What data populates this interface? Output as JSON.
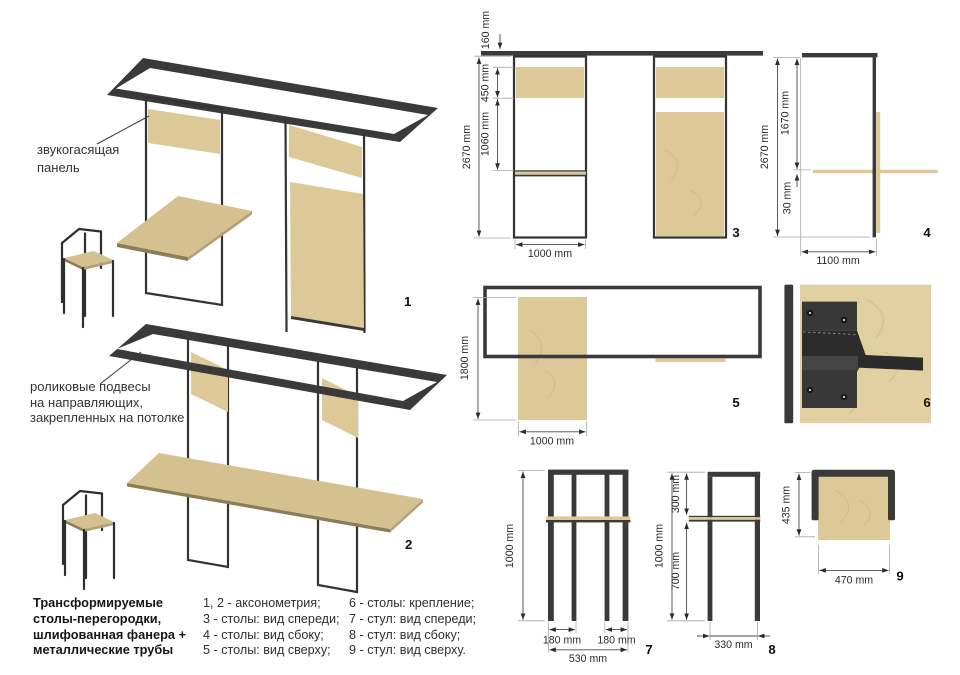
{
  "title_block": {
    "lines": [
      "Трансформируемые",
      "столы-перегородки,",
      "шлифованная фанера +",
      "металлические трубы"
    ]
  },
  "legend": {
    "col1": [
      "1, 2 - аксонометрия;",
      "3 - столы: вид спереди;",
      "4 - столы: вид сбоку;",
      "5 - столы: вид сверху;"
    ],
    "col2": [
      "6 - столы: крепление;",
      "7 - стул: вид спереди;",
      "8 - стул: вид сбоку;",
      "9 - стул: вид сверху."
    ]
  },
  "annotations": {
    "panel": [
      "звукогасящая",
      "панель"
    ],
    "rollers": [
      "роликовые подвесы",
      "на направляющих,",
      "закрепленных на потолке"
    ]
  },
  "view_labels": {
    "v1": "1",
    "v2": "2",
    "v3": "3",
    "v4": "4",
    "v5": "5",
    "v6": "6",
    "v7": "7",
    "v8": "8",
    "v9": "9"
  },
  "dims": {
    "v3": {
      "d160": "160 mm",
      "d450": "450 mm",
      "d1060": "1060 mm",
      "d2670": "2670 mm",
      "w1000": "1000 mm"
    },
    "v4": {
      "d2670": "2670 mm",
      "d1670": "1670 mm",
      "d30": "30 mm",
      "w1100": "1100 mm"
    },
    "v5": {
      "d1800": "1800 mm",
      "w1000": "1000 mm"
    },
    "v7": {
      "h1000": "1000 mm",
      "w180a": "180 mm",
      "w180b": "180 mm",
      "w530": "530 mm"
    },
    "v8": {
      "h1000": "1000 mm",
      "h300": "300 mm",
      "h700": "700 mm",
      "w330": "330 mm"
    },
    "v9": {
      "h435": "435 mm",
      "w470": "470 mm"
    }
  },
  "colors": {
    "wood": "#ddc897",
    "wood_table": "#d5c190",
    "wood_edge": "#8d7c58",
    "metal": "#3a3a3a",
    "background": "#ffffff",
    "dim_text": "#2b2b2b"
  }
}
